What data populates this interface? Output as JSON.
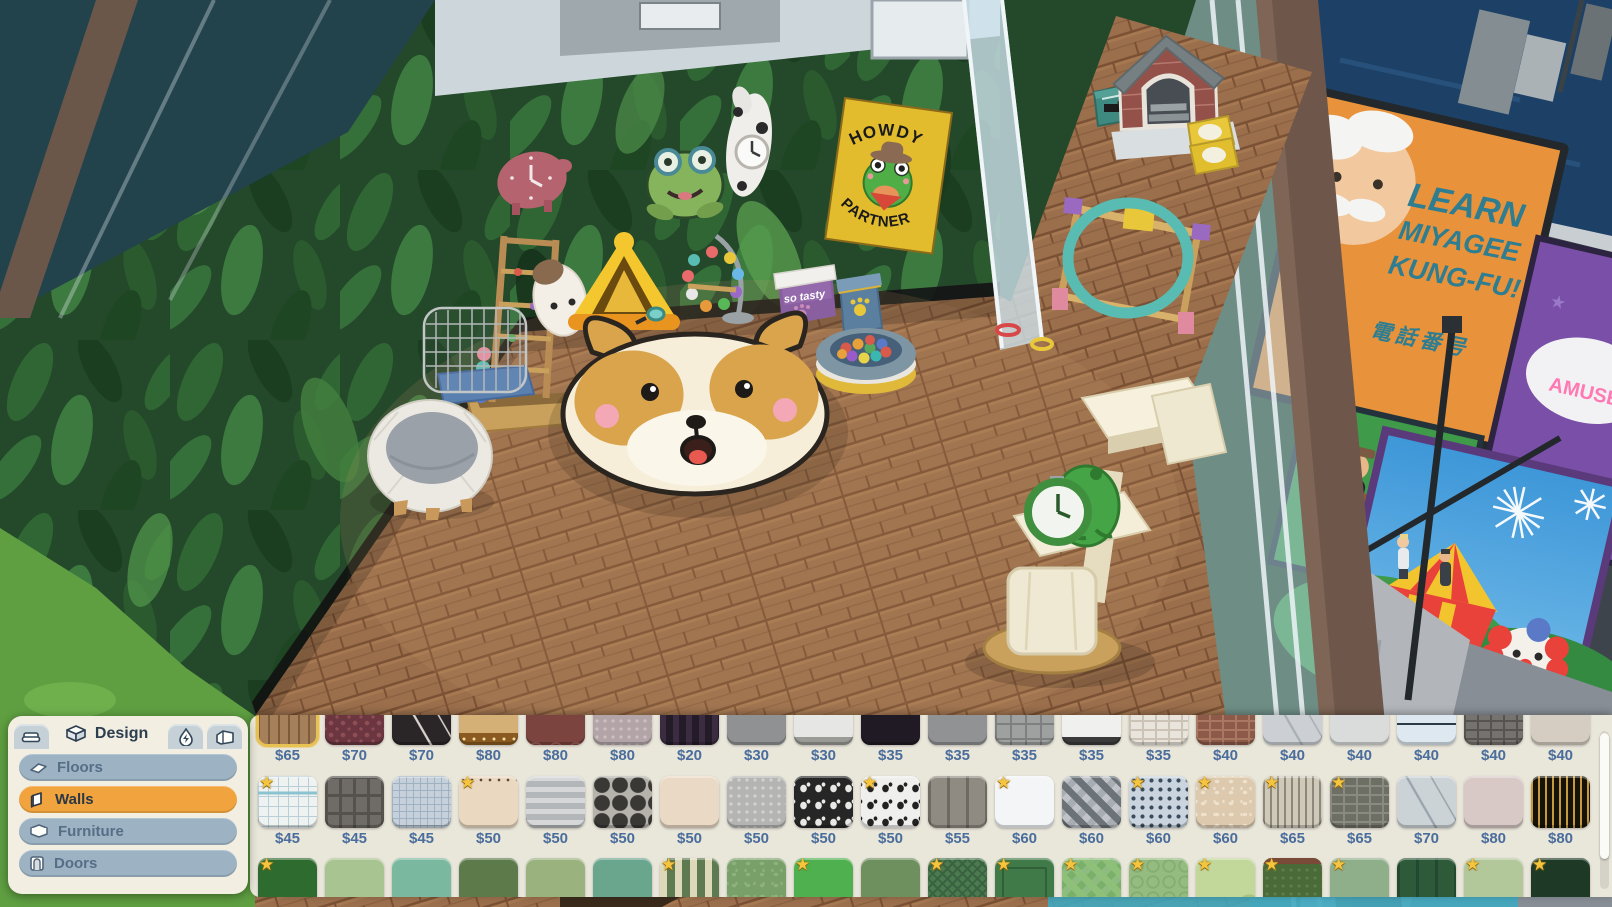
{
  "scene": {
    "poster": {
      "line1": "HOWDY",
      "line2": "PARTNER"
    },
    "cooler_label": "so tasty",
    "billboards": {
      "kungfu_line1": "LEARN",
      "kungfu_line2": "MIYAGEE",
      "kungfu_line3": "KUNG-FU!",
      "kungfu_sub": "電話番号",
      "band_partial": "AND",
      "amusement_partial": "AMUSE",
      "visit_partial": "Vi"
    }
  },
  "design_panel": {
    "tabs": {
      "design_label": "Design"
    },
    "categories": [
      {
        "label": "Floors",
        "active": false
      },
      {
        "label": "Walls",
        "active": true
      },
      {
        "label": "Furniture",
        "active": false
      },
      {
        "label": "Doors",
        "active": false
      }
    ]
  },
  "colors": {
    "accent_orange": "#f1a43e",
    "price_blue": "#4a6d9c",
    "star_yellow": "#f6c53d",
    "selected_gold": "#e8c153",
    "panel_cream": "#e9e6da"
  },
  "catalog": {
    "rows": [
      {
        "name": "row-1",
        "items": [
          {
            "price": "$65",
            "bg": "#a5805a",
            "pattern": "wood-v",
            "fg": "#7e5c3a",
            "selected": true
          },
          {
            "price": "$70",
            "bg": "#6b3640",
            "pattern": "damask",
            "fg": "#8e4e56"
          },
          {
            "price": "$70",
            "bg": "#2a2527",
            "pattern": "marble",
            "fg": "#d8d2cc"
          },
          {
            "price": "$80",
            "bg": "#d4b077",
            "pattern": "band-bottom",
            "fg": "#8a5a20"
          },
          {
            "price": "$80",
            "bg": "#7c443e",
            "pattern": "arches",
            "fg": "#a06058"
          },
          {
            "price": "$80",
            "bg": "#b3a4a8",
            "pattern": "ornate",
            "fg": "#cdbfc2"
          },
          {
            "price": "$20",
            "bg": "#241b28",
            "pattern": "stripes-v",
            "fg": "#3c2c42"
          },
          {
            "price": "$30",
            "bg": "#8f9193",
            "pattern": "plain"
          },
          {
            "price": "$30",
            "bg": "#e6e6e4",
            "pattern": "base",
            "fg": "#9a9a96"
          },
          {
            "price": "$35",
            "bg": "#201a24",
            "pattern": "plain"
          },
          {
            "price": "$35",
            "bg": "#909294",
            "pattern": "plain"
          },
          {
            "price": "$35",
            "bg": "#9fa1a0",
            "pattern": "tiles",
            "fg": "#7e807f"
          },
          {
            "price": "$35",
            "bg": "#f0f0ee",
            "pattern": "base",
            "fg": "#3a3a3a"
          },
          {
            "price": "$35",
            "bg": "#e9e5dc",
            "pattern": "brick",
            "fg": "#cbc4b6"
          },
          {
            "price": "$40",
            "bg": "#8d5a49",
            "pattern": "brick",
            "fg": "#a97863"
          },
          {
            "price": "$40",
            "bg": "#ccd0d4",
            "pattern": "marble",
            "fg": "#a8b0b6"
          },
          {
            "price": "$40",
            "bg": "#dadcdb",
            "pattern": "plain"
          },
          {
            "price": "$40",
            "bg": "#dde8f0",
            "pattern": "lines-h2",
            "fg": "#2c3a48"
          },
          {
            "price": "$40",
            "bg": "#76736e",
            "pattern": "brick",
            "fg": "#565450"
          },
          {
            "price": "$40",
            "bg": "#d6cdc2",
            "pattern": "plain"
          }
        ]
      },
      {
        "name": "row-2",
        "items": [
          {
            "price": "$45",
            "bg": "#eef2f1",
            "pattern": "graph",
            "fg": "#b9ced6",
            "star": true
          },
          {
            "price": "$45",
            "bg": "#6f6b66",
            "pattern": "blocks",
            "fg": "#55524e"
          },
          {
            "price": "$45",
            "bg": "#c6d0da",
            "pattern": "grid",
            "fg": "#9fb2c2"
          },
          {
            "price": "$50",
            "bg": "#ead9c0",
            "pattern": "squiggle",
            "fg": "#5a4a3a",
            "star": true
          },
          {
            "price": "$50",
            "bg": "#b4b7b9",
            "pattern": "stripes-h",
            "fg": "#d5d7d8"
          },
          {
            "price": "$50",
            "bg": "#b6b3ac",
            "pattern": "octagons",
            "fg": "#3a3835"
          },
          {
            "price": "$50",
            "bg": "#ead9c4",
            "pattern": "plain"
          },
          {
            "price": "$50",
            "bg": "#b4b4b2",
            "pattern": "ornate",
            "fg": "#d2d2d0"
          },
          {
            "price": "$50",
            "bg": "#262626",
            "pattern": "cats",
            "fg": "#e8e8e6"
          },
          {
            "price": "$50",
            "bg": "#efefed",
            "pattern": "cats",
            "fg": "#222222",
            "star": true
          },
          {
            "price": "$55",
            "bg": "#8f8a82",
            "pattern": "panels",
            "fg": "#6e6a62"
          },
          {
            "price": "$60",
            "bg": "#f3f5f7",
            "pattern": "plain",
            "star": true
          },
          {
            "price": "$60",
            "bg": "#a8adb3",
            "pattern": "triangles",
            "fg": "#6b7278"
          },
          {
            "price": "$60",
            "bg": "#c9d4de",
            "pattern": "dots",
            "fg": "#3c4c5c",
            "star": true
          },
          {
            "price": "$60",
            "bg": "#dcc9ae",
            "pattern": "mottled",
            "fg": "#efe2cc",
            "star": true
          },
          {
            "price": "$65",
            "bg": "#cfc9ba",
            "pattern": "pinstripe",
            "fg": "#8e887a",
            "star": true
          },
          {
            "price": "$65",
            "bg": "#6d6e64",
            "pattern": "brick",
            "fg": "#8a8b80",
            "star": true
          },
          {
            "price": "$70",
            "bg": "#ccd3d6",
            "pattern": "marble",
            "fg": "#9aa4ac"
          },
          {
            "price": "$80",
            "bg": "#d8c8c6",
            "pattern": "plain"
          },
          {
            "price": "$80",
            "bg": "#171208",
            "pattern": "pinstripe",
            "fg": "#c59a3e"
          }
        ]
      },
      {
        "name": "row-3",
        "items": [
          {
            "bg": "#2e6b2e",
            "pattern": "plain",
            "star": true
          },
          {
            "bg": "#a8c490",
            "pattern": "plain"
          },
          {
            "bg": "#7ab8a0",
            "pattern": "plain"
          },
          {
            "bg": "#5d7a4a",
            "pattern": "plain"
          },
          {
            "bg": "#9ab37e",
            "pattern": "plain"
          },
          {
            "bg": "#6aa58e",
            "pattern": "plain"
          },
          {
            "bg": "#5d7a50",
            "pattern": "stripes-v-wide",
            "fg": "#ddd9b8",
            "star": true
          },
          {
            "bg": "#7aa06a",
            "pattern": "mottled",
            "fg": "#8fb27a"
          },
          {
            "bg": "#4eb04e",
            "pattern": "plain",
            "star": true
          },
          {
            "bg": "#6e8f5e",
            "pattern": "plain"
          },
          {
            "bg": "#4a7a4e",
            "pattern": "herringbone",
            "fg": "#3a6140",
            "star": true
          },
          {
            "bg": "#3f7a48",
            "pattern": "frame",
            "fg": "#2f6038",
            "star": true
          },
          {
            "bg": "#7ab06a",
            "pattern": "argyle",
            "fg": "#8fc07a",
            "star": true
          },
          {
            "bg": "#95bc80",
            "pattern": "circles",
            "fg": "#86ad72",
            "star": true
          },
          {
            "bg": "#c2d89a",
            "pattern": "camo",
            "fg": "#a8c47e",
            "star": true
          },
          {
            "bg": "#4a6b38",
            "pattern": "ornate",
            "fg": "#5d7e48",
            "star": true,
            "topbar": "#7a4a38"
          },
          {
            "bg": "#8fae8a",
            "pattern": "plain",
            "star": true
          },
          {
            "bg": "#2f5a3a",
            "pattern": "panels",
            "fg": "#234830",
            "botbar": "#6b4632"
          },
          {
            "bg": "#b2c79a",
            "pattern": "plain",
            "star": true
          },
          {
            "bg": "#1e3a26",
            "pattern": "plain",
            "star": true
          }
        ]
      }
    ]
  }
}
